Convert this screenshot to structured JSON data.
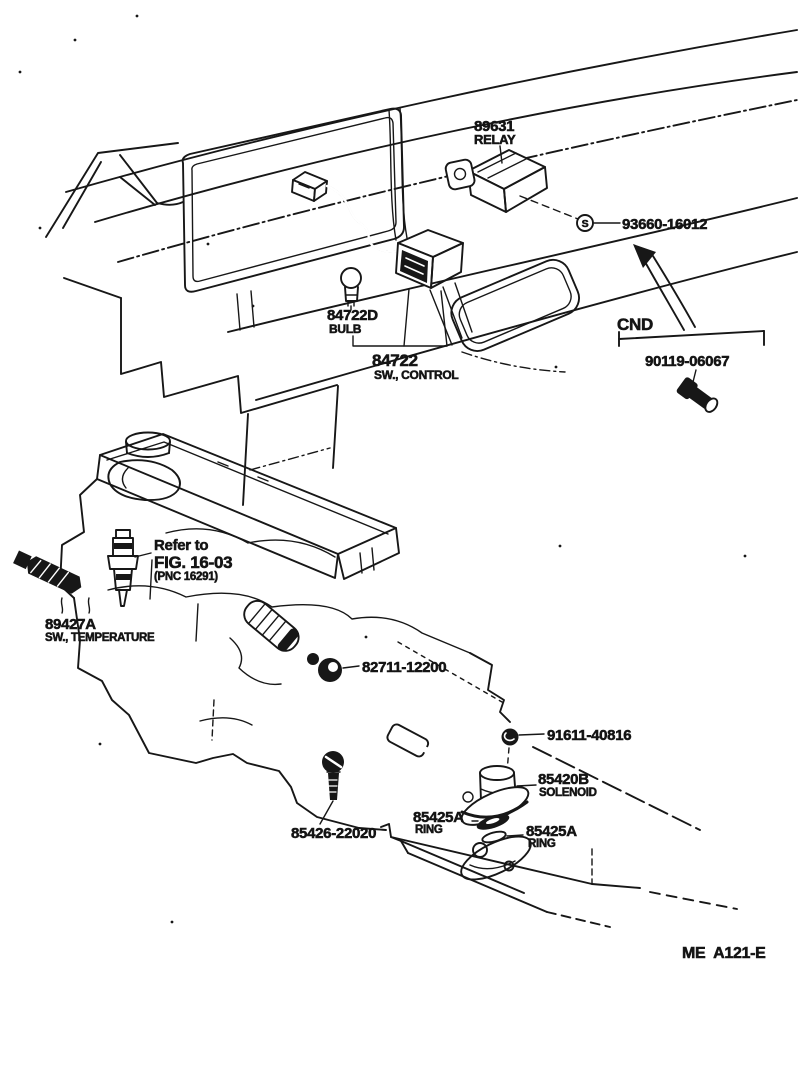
{
  "labels": {
    "relay_part": "89631",
    "relay_name": "RELAY",
    "screw_symbol": "S",
    "screw_part": "93660-16012",
    "bulb_part": "84722D",
    "bulb_name": "BULB",
    "control_part": "84722",
    "control_name": "SW., CONTROL",
    "cnd": "CND",
    "cnd_bolt_part": "90119-06067",
    "refer_1": "Refer to",
    "refer_2": "FIG. 16-03",
    "refer_3": "(PNC 16291)",
    "temp_part": "89427A",
    "temp_name": "SW., TEMPERATURE",
    "clamp_part": "82711-12200",
    "nut_part": "91611-40816",
    "solenoid_part": "85420B",
    "solenoid_name": "SOLENOID",
    "ring1_part": "85425A",
    "ring1_name": "RING",
    "ring2_part": "85425A",
    "ring2_name": "RING",
    "bolt_part": "85426-22020",
    "figure_code": "ME  A121-E"
  },
  "colors": {
    "ink": "#171717",
    "paper": "#ffffff"
  }
}
